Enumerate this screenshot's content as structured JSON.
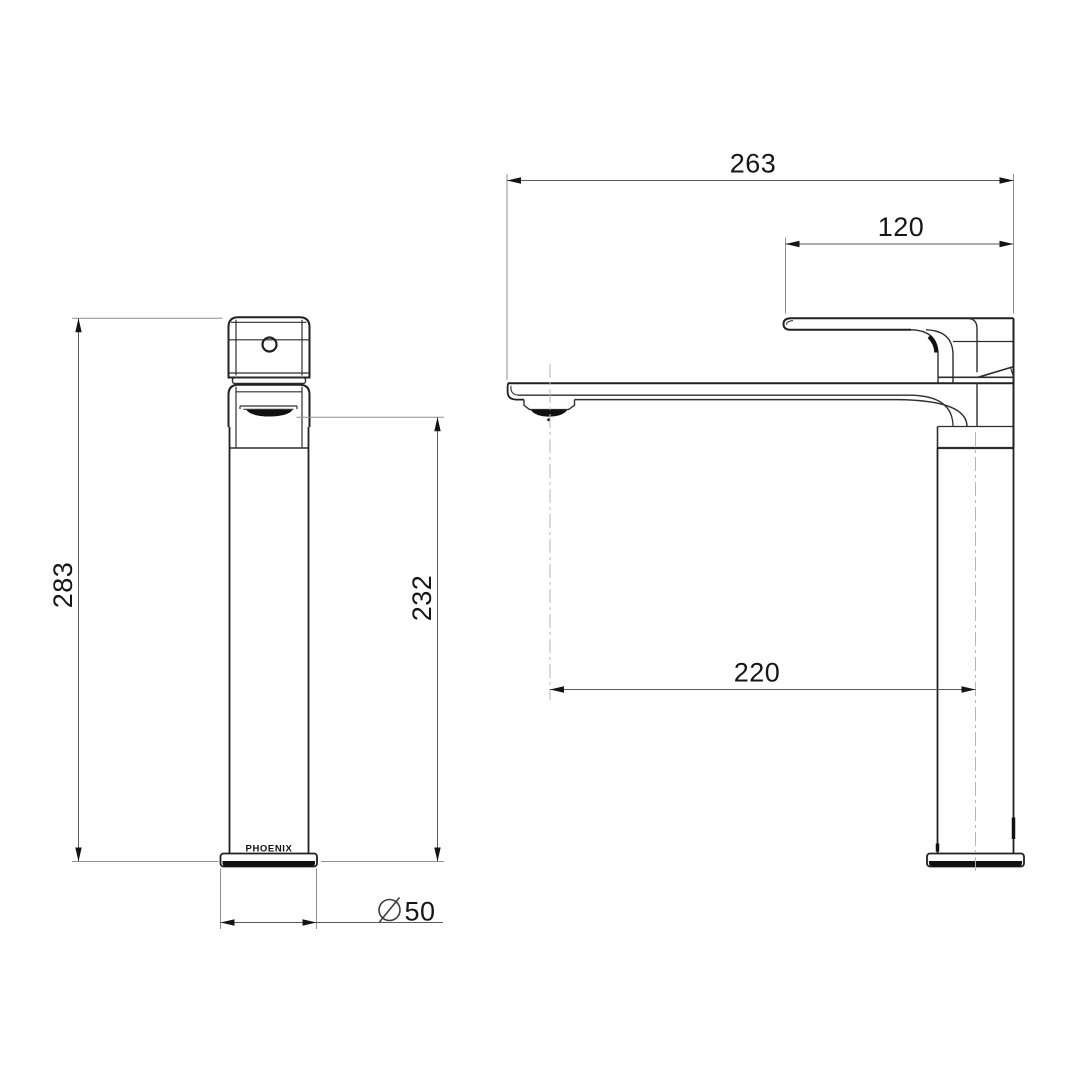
{
  "drawing": {
    "brand_label": "PHOENIX",
    "dimensions": {
      "overall_height": "283",
      "spout_outlet_height": "232",
      "base_diameter": "50",
      "diameter_symbol": "⌀",
      "overall_depth": "263",
      "handle_reach": "120",
      "spout_reach": "220"
    },
    "colors": {
      "background": "#ffffff",
      "outline": "#212121",
      "dimension_line": "#5a5a5a",
      "extension_line": "#8f8f8f",
      "centerline": "#b5b5b5",
      "text": "#161616"
    }
  }
}
